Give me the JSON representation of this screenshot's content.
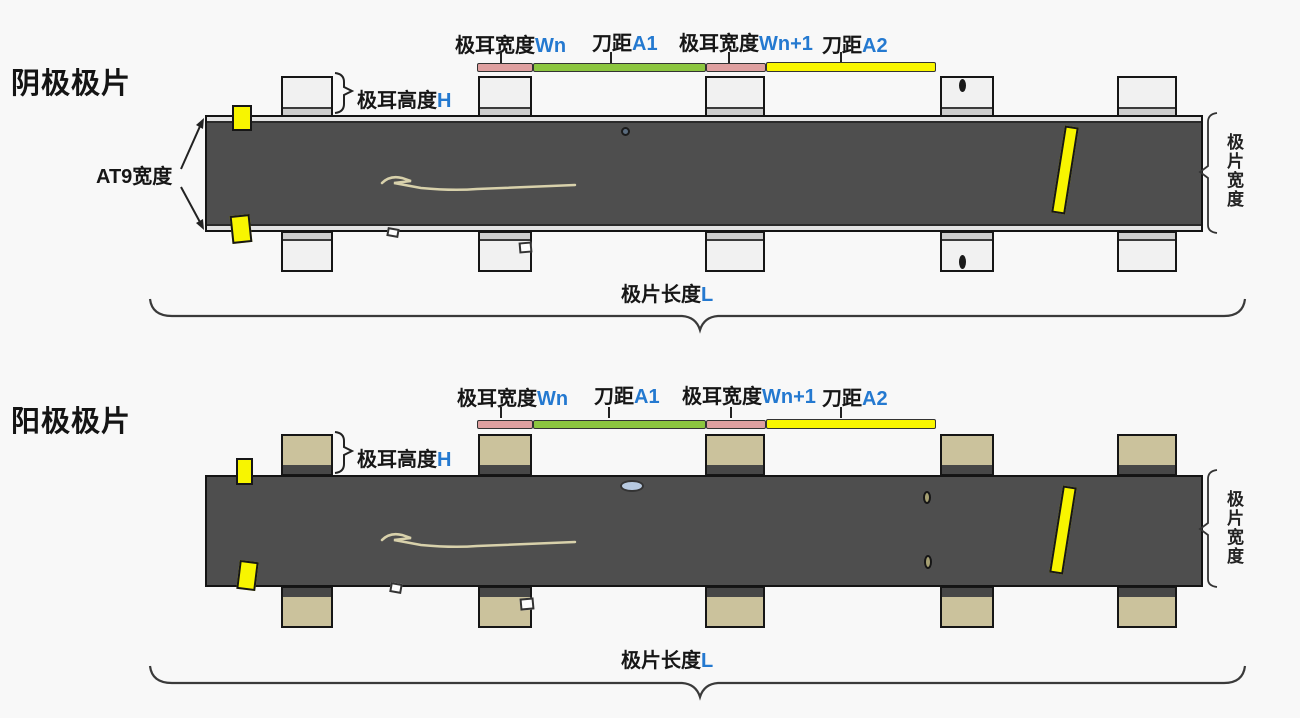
{
  "colors": {
    "background": "#f8f8f8",
    "strip": "#4e4e4e",
    "cathode_tab": "#f1f1f1",
    "cathode_tab_band": "#cdcdcd",
    "anode_tab": "#cbc29c",
    "anode_tab_band": "#474747",
    "marker_yellow": "#f8f500",
    "bar_pink": "#dfa0a0",
    "bar_green": "#8cc63f",
    "bar_yellow": "#f9f600",
    "variable_blue": "#2479d0"
  },
  "cathode": {
    "title": "阴极极片",
    "at9_width_label": "AT9宽度",
    "tab_height": {
      "zh": "极耳高度",
      "var": "H"
    },
    "dims": {
      "tab_width_n": {
        "zh": "极耳宽度",
        "var": "Wn"
      },
      "knife_a1": {
        "zh": "刀距",
        "var": "A1"
      },
      "tab_width_n1": {
        "zh": "极耳宽度",
        "var": "Wn+1"
      },
      "knife_a2": {
        "zh": "刀距",
        "var": "A2"
      }
    },
    "sheet_width_label": "极片宽度",
    "sheet_length": {
      "zh": "极片长度",
      "var": "L"
    }
  },
  "anode": {
    "title": "阳极极片",
    "tab_height": {
      "zh": "极耳高度",
      "var": "H"
    },
    "dims": {
      "tab_width_n": {
        "zh": "极耳宽度",
        "var": "Wn"
      },
      "knife_a1": {
        "zh": "刀距",
        "var": "A1"
      },
      "tab_width_n1": {
        "zh": "极耳宽度",
        "var": "Wn+1"
      },
      "knife_a2": {
        "zh": "刀距",
        "var": "A2"
      }
    },
    "sheet_width_label": "极片宽度",
    "sheet_length": {
      "zh": "极片长度",
      "var": "L"
    }
  }
}
